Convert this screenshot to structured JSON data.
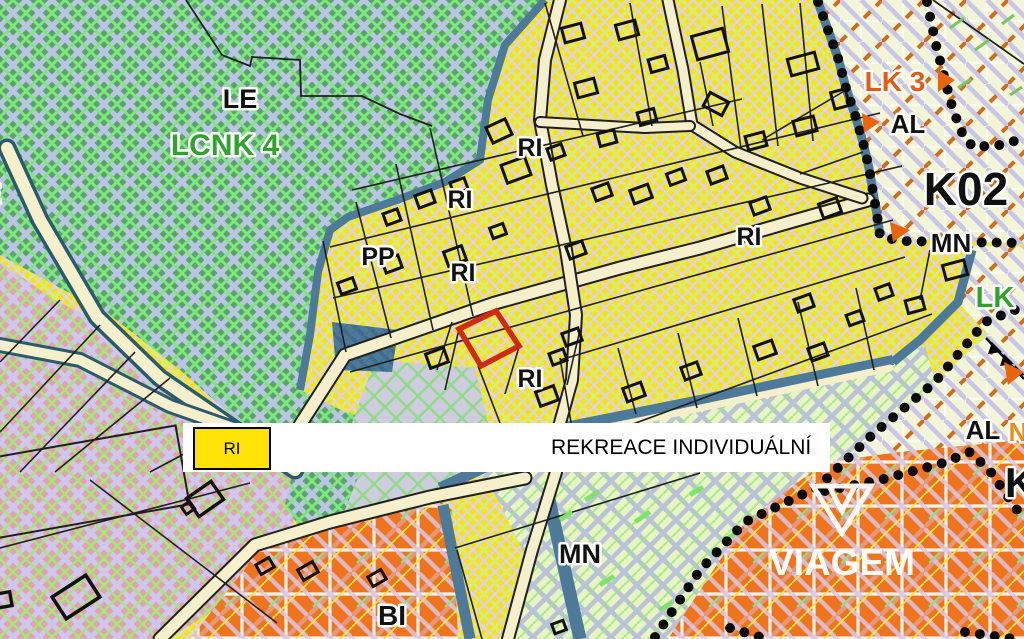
{
  "map": {
    "legend": {
      "code": "RI",
      "label": "REKREACE INDIVIDUÁLNÍ",
      "swatch_color": "#FFE206"
    },
    "watermark": {
      "text": "VIAGEM"
    },
    "highlight": {
      "color": "#D22A0E"
    },
    "colors": {
      "zone_recreation_yellow": "#FFE206",
      "zone_forest_green": "#5BA26C",
      "zone_pink": "#E2A3AE",
      "zone_orange": "#F0731D",
      "zone_cream": "#F3F5D8",
      "zone_pale_green": "#E7F5C3",
      "zone_slate": "#4D7A99",
      "road_cream": "#F5F0CB",
      "boundary_dots": "#0A0A0A"
    },
    "labels": [
      {
        "text": "E",
        "x": -8,
        "y": 203,
        "size": 27,
        "color": "#111111"
      },
      {
        "text": "LE",
        "x": 240,
        "y": 108,
        "size": 27,
        "color": "#111111"
      },
      {
        "text": "LCNK 4",
        "x": 225,
        "y": 155,
        "size": 30,
        "color": "#2fa32c"
      },
      {
        "text": "RI",
        "x": 530,
        "y": 156,
        "size": 25,
        "color": "#111111"
      },
      {
        "text": "RI",
        "x": 460,
        "y": 208,
        "size": 25,
        "color": "#111111"
      },
      {
        "text": "PP",
        "x": 378,
        "y": 265,
        "size": 25,
        "color": "#111111"
      },
      {
        "text": "RI",
        "x": 463,
        "y": 281,
        "size": 25,
        "color": "#111111"
      },
      {
        "text": "RI",
        "x": 749,
        "y": 245,
        "size": 25,
        "color": "#111111"
      },
      {
        "text": "RI",
        "x": 530,
        "y": 387,
        "size": 25,
        "color": "#111111"
      },
      {
        "text": "MN",
        "x": 580,
        "y": 563,
        "size": 27,
        "color": "#111111"
      },
      {
        "text": "BI",
        "x": 392,
        "y": 625,
        "size": 28,
        "color": "#111111"
      },
      {
        "text": "LK 3",
        "x": 895,
        "y": 91,
        "size": 28,
        "color": "#E65B11"
      },
      {
        "text": "AL",
        "x": 908,
        "y": 133,
        "size": 26,
        "color": "#111111"
      },
      {
        "text": "K02",
        "x": 966,
        "y": 205,
        "size": 46,
        "color": "#111111"
      },
      {
        "text": "MN",
        "x": 951,
        "y": 252,
        "size": 26,
        "color": "#111111"
      },
      {
        "text": "LK",
        "x": 995,
        "y": 307,
        "size": 29,
        "color": "#2fa32c"
      },
      {
        "text": "AL",
        "x": 983,
        "y": 439,
        "size": 26,
        "color": "#111111"
      },
      {
        "text": "N",
        "x": 1018,
        "y": 441,
        "size": 26,
        "color": "#F28A16"
      },
      {
        "text": "K",
        "x": 1020,
        "y": 497,
        "size": 42,
        "color": "#111111"
      },
      {
        "text": "VIAGEM",
        "x": 842,
        "y": 575,
        "size": 37,
        "color": "#FFFFFF",
        "halo": 0
      }
    ]
  }
}
